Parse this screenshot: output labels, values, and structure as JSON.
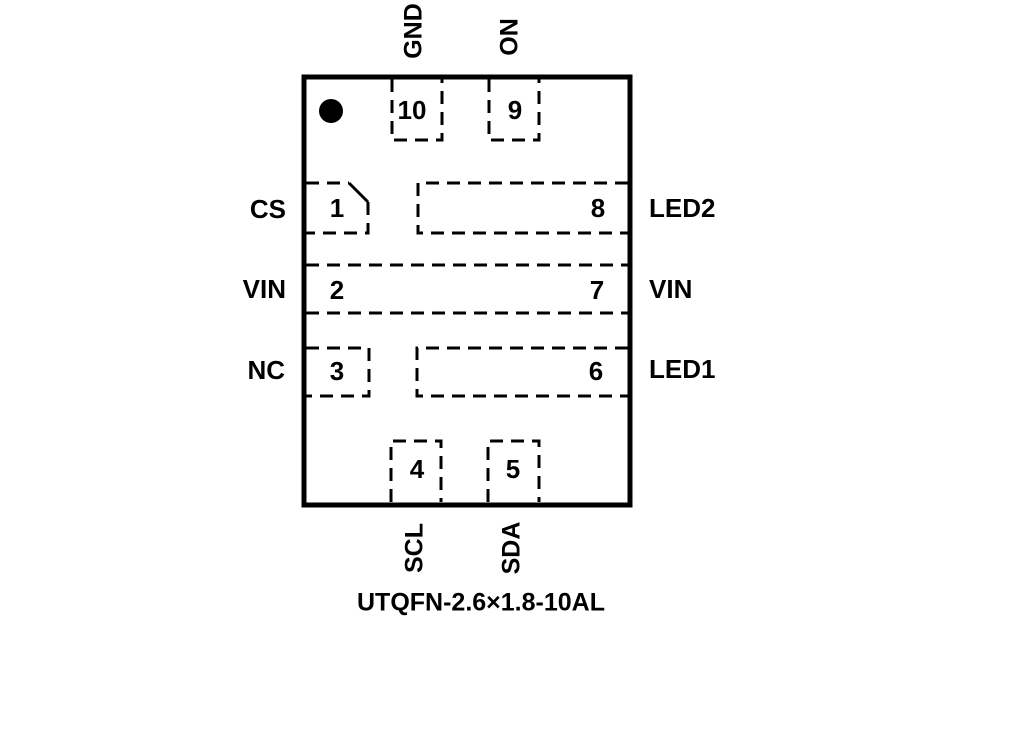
{
  "diagram": {
    "caption": "UTQFN-2.6×1.8-10AL",
    "colors": {
      "line": "#000000",
      "background": "#ffffff"
    },
    "pins": [
      {
        "number": "1",
        "name": "CS",
        "side": "left"
      },
      {
        "number": "2",
        "name": "VIN",
        "side": "left"
      },
      {
        "number": "3",
        "name": "NC",
        "side": "left"
      },
      {
        "number": "4",
        "name": "SCL",
        "side": "bottom"
      },
      {
        "number": "5",
        "name": "SDA",
        "side": "bottom"
      },
      {
        "number": "6",
        "name": "LED1",
        "side": "right"
      },
      {
        "number": "7",
        "name": "VIN",
        "side": "right"
      },
      {
        "number": "8",
        "name": "LED2",
        "side": "right"
      },
      {
        "number": "9",
        "name": "ON",
        "side": "top"
      },
      {
        "number": "10",
        "name": "GND",
        "side": "top"
      }
    ]
  }
}
